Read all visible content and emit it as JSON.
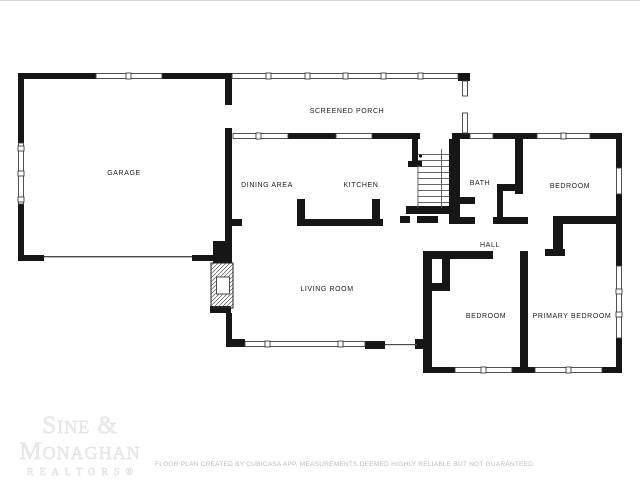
{
  "floor_plan": {
    "wall_color": "#161616",
    "rooms": [
      {
        "id": "garage",
        "label": "GARAGE"
      },
      {
        "id": "screened-porch",
        "label": "SCREENED PORCH"
      },
      {
        "id": "dining-area",
        "label": "DINING AREA"
      },
      {
        "id": "kitchen",
        "label": "KITCHEN"
      },
      {
        "id": "bath",
        "label": "BATH"
      },
      {
        "id": "bedroom-upper",
        "label": "BEDROOM"
      },
      {
        "id": "hall",
        "label": "HALL"
      },
      {
        "id": "living-room",
        "label": "LIVING ROOM"
      },
      {
        "id": "bedroom-lower",
        "label": "BEDROOM"
      },
      {
        "id": "primary-bedroom",
        "label": "PRIMARY BEDROOM"
      }
    ]
  },
  "watermark": {
    "line1": "Sine &",
    "line2": "Monaghan",
    "line3": "REALTORS®"
  },
  "disclaimer": "FLOOR PLAN CREATED BY CUBICASA APP, MEASUREMENTS DEEMED HIGHLY RELIABLE BUT NOT GUARANTEED."
}
